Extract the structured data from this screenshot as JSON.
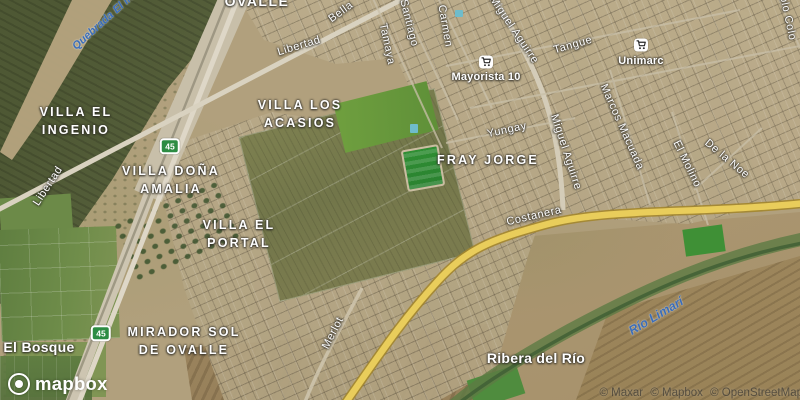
{
  "map": {
    "town": "OVALLE",
    "neighborhoods": [
      {
        "line1": "VILLA EL",
        "line2": "INGENIO"
      },
      {
        "line1": "VILLA LOS",
        "line2": "ACASIOS"
      },
      {
        "line1": "VILLA DOÑA",
        "line2": "AMALIA"
      },
      {
        "line1": "VILLA EL",
        "line2": "PORTAL"
      },
      {
        "line1": "MIRADOR SOL",
        "line2": "DE OVALLE"
      },
      {
        "line1": "FRAY JORGE",
        "line2": ""
      }
    ],
    "localities": [
      {
        "name": "El Bosque"
      },
      {
        "name": "Ribera del Río"
      }
    ],
    "streets": [
      {
        "name": "Libertad"
      },
      {
        "name": "Libertad"
      },
      {
        "name": "Bella"
      },
      {
        "name": "Santiago"
      },
      {
        "name": "Tamaya"
      },
      {
        "name": "Carmen"
      },
      {
        "name": "Miguel Aguirre"
      },
      {
        "name": "Tangue"
      },
      {
        "name": "Yungay"
      },
      {
        "name": "Miguel Aguirre"
      },
      {
        "name": "Marcos Macuada"
      },
      {
        "name": "El Molino"
      },
      {
        "name": "De la Noe"
      },
      {
        "name": "Colo Colo"
      },
      {
        "name": "Costanera"
      },
      {
        "name": "Merlot"
      }
    ],
    "water_labels": [
      {
        "name": "Quebrada El In"
      },
      {
        "name": "Río Limarí"
      }
    ],
    "pois": [
      {
        "name": "Mayorista 10",
        "icon": "shopping-cart"
      },
      {
        "name": "Unimarc",
        "icon": "shopping-cart"
      }
    ],
    "route_shields": [
      {
        "number": "45"
      },
      {
        "number": "45"
      }
    ],
    "logo_text": "mapbox",
    "attribution": [
      {
        "text": "© Maxar"
      },
      {
        "text": "© Mapbox"
      },
      {
        "text": "© OpenStreetMap"
      }
    ],
    "colors": {
      "shield_green": "#2d8c43",
      "highway_yellow": "#e9cd5b",
      "water_label_blue": "#3b6db8"
    }
  }
}
